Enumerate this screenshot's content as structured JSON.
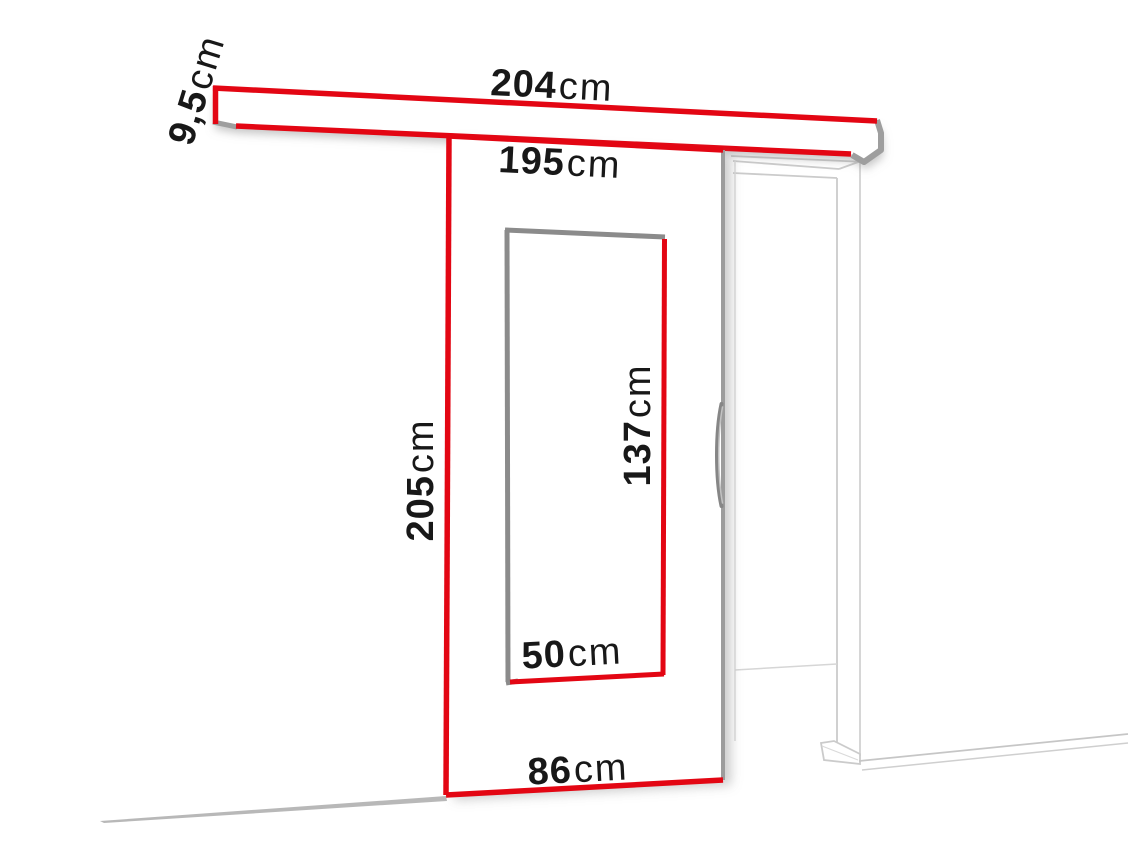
{
  "diagram": {
    "kind": "sliding-door-dimension-diagram",
    "subject": "sliding door on wall-mounted rail with door frame",
    "background": "#ffffff",
    "colors": {
      "dimension_red": "#e30613",
      "edge_gray": "#8b8b8b",
      "frame_light_gray": "#cbcbcb",
      "text": "#181818"
    },
    "labels": {
      "rail_length": {
        "value": "204",
        "unit": "cm"
      },
      "rail_height": {
        "value": "9,5",
        "unit": "cm"
      },
      "track_length": {
        "value": "195",
        "unit": "cm"
      },
      "door_height": {
        "value": "205",
        "unit": "cm"
      },
      "glass_height": {
        "value": "137",
        "unit": "cm"
      },
      "glass_width": {
        "value": "50",
        "unit": "cm"
      },
      "door_width": {
        "value": "86",
        "unit": "cm"
      }
    }
  }
}
